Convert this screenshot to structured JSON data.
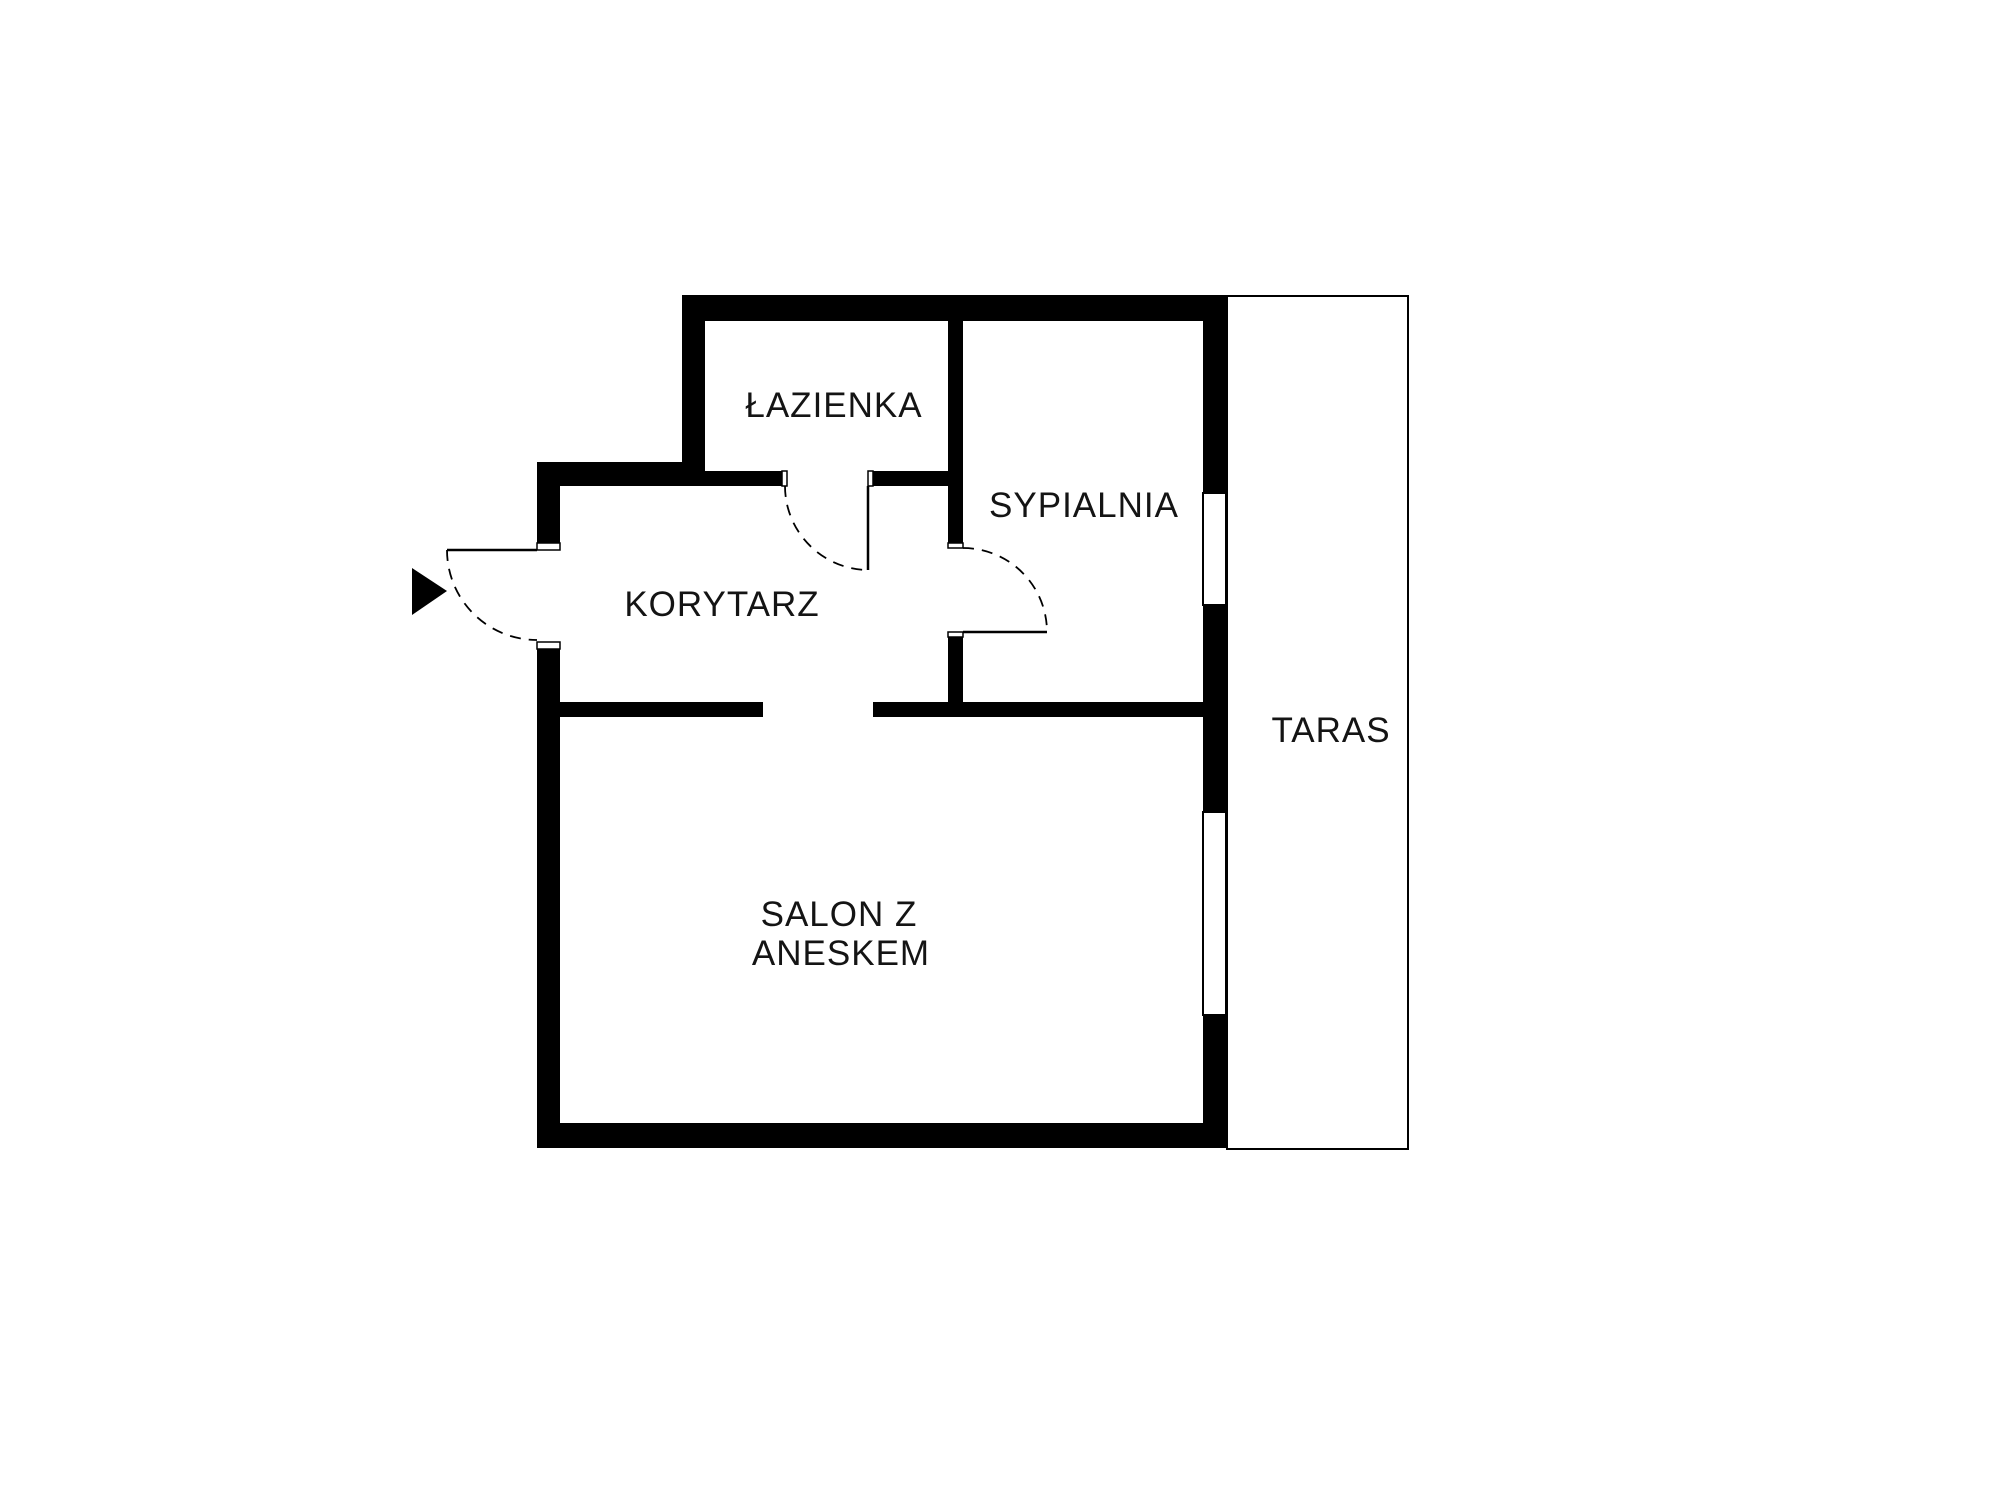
{
  "page": {
    "background": "#ffffff"
  },
  "colors": {
    "wall": "#000000",
    "text": "#141414",
    "outline": "#000000",
    "background": "#ffffff"
  },
  "icons": {
    "entrance_arrow": "right-pointing-triangle"
  },
  "rooms": {
    "bathroom": {
      "label": "ŁAZIENKA"
    },
    "bedroom": {
      "label": "SYPIALNIA"
    },
    "corridor": {
      "label": "KORYTARZ"
    },
    "living_room": {
      "label_line1": "SALON Z",
      "label_line2": "ANESKEM"
    },
    "terrace": {
      "label": "TARAS"
    }
  }
}
